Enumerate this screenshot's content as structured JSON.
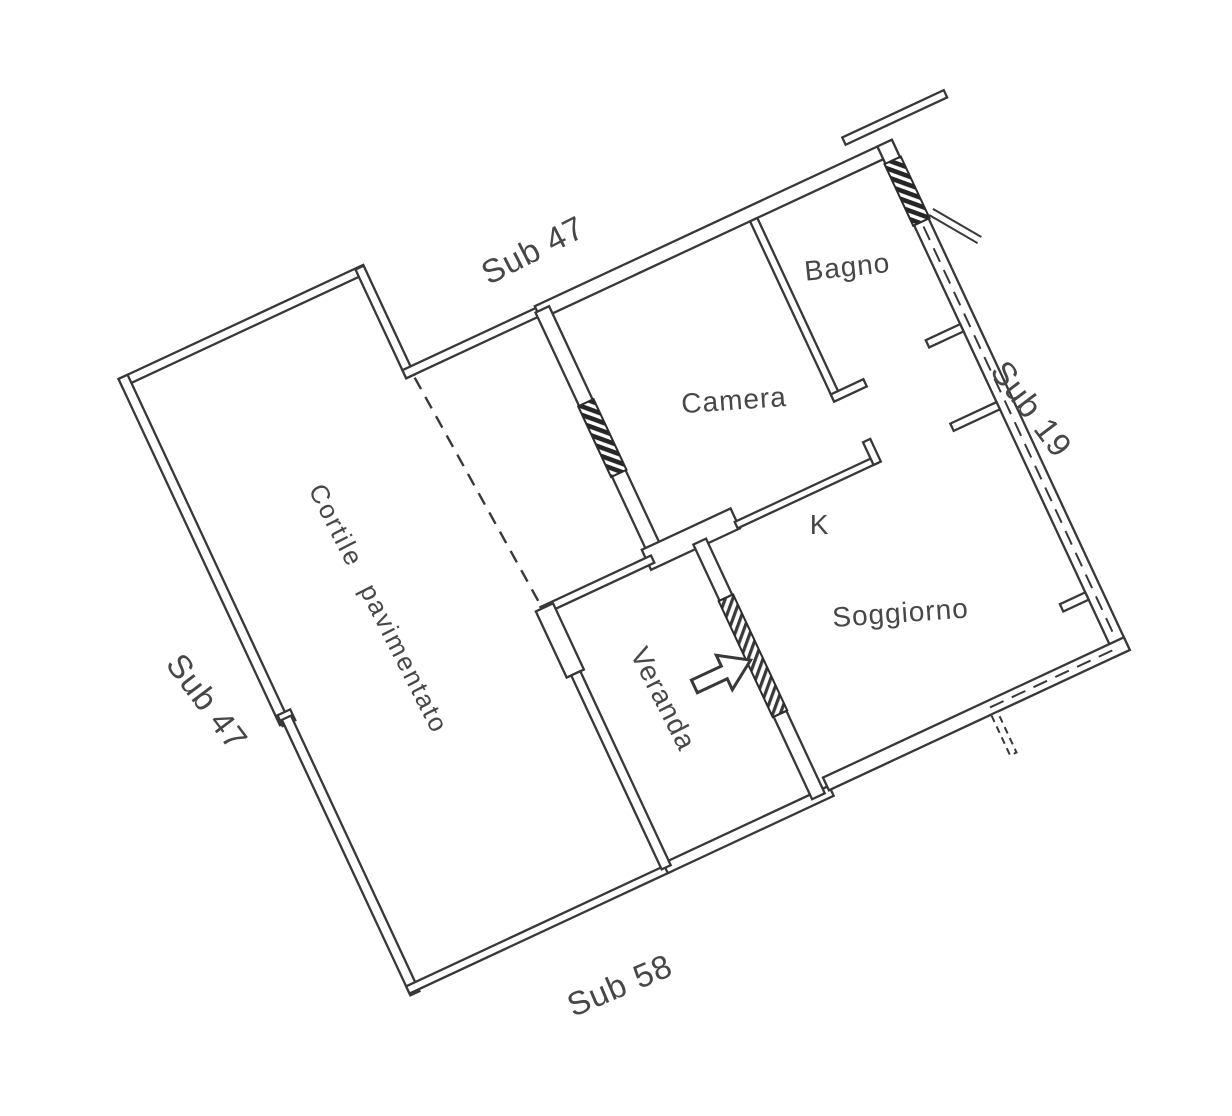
{
  "document": {
    "kind": "cadastral floor plan (scanned line drawing)",
    "paper_color": "#ffffff",
    "ink_color": "#383838",
    "text_color": "#474747"
  },
  "floor_plan": {
    "rooms": [
      {
        "id": "camera",
        "label": "Camera"
      },
      {
        "id": "bagno",
        "label": "Bagno"
      },
      {
        "id": "soggiorno",
        "label": "Soggiorno"
      },
      {
        "id": "kitchen",
        "label": "K"
      },
      {
        "id": "veranda",
        "label": "Veranda"
      },
      {
        "id": "courtyard",
        "label": "Cortile pavimentato"
      }
    ],
    "subdivisions": [
      {
        "id": "sub47-north",
        "label": "Sub 47",
        "position": "north boundary"
      },
      {
        "id": "sub47-west",
        "label": "Sub 47",
        "position": "west boundary"
      },
      {
        "id": "sub19-east",
        "label": "Sub 19",
        "position": "east boundary"
      },
      {
        "id": "sub58-south",
        "label": "Sub 58",
        "position": "south boundary"
      }
    ],
    "features": {
      "entrance_arrow": "entrance-direction-arrow",
      "windows": [
        "camera-window",
        "bagno-window"
      ],
      "glazed_wall": "veranda-glazed-door",
      "dashed_line": "courtyard-division-line"
    }
  }
}
